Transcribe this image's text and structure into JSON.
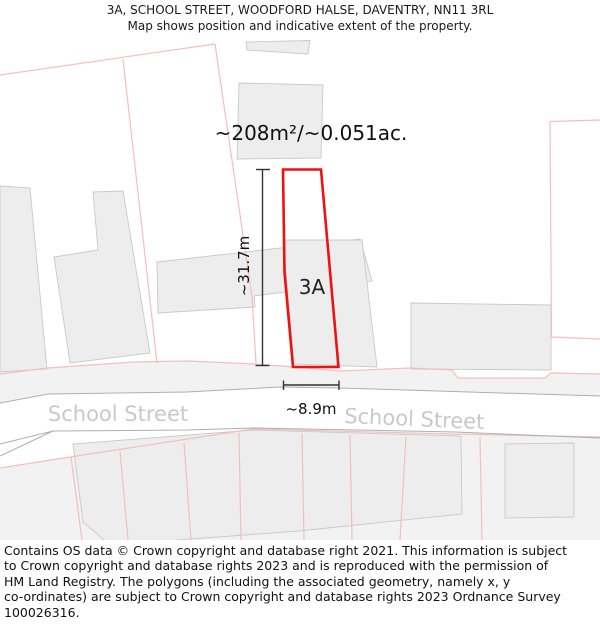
{
  "header": {
    "title": "3A, SCHOOL STREET, WOODFORD HALSE, DAVENTRY, NN11 3RL",
    "subtitle": "Map shows position and indicative extent of the property."
  },
  "map": {
    "colors": {
      "property_red": "#ee1111",
      "parcel_line": "#f4bfbb",
      "building_fill": "#ededed",
      "building_stroke": "#c9c9c9",
      "region_fill": "#f2f2f2",
      "street_edge": "#aeaeae",
      "measure": "#333333",
      "street_label": "#c9c9c9"
    },
    "labels": [
      {
        "name": "area-label",
        "text": "~208m²/~0.051ac.",
        "x": 311,
        "y": 140,
        "size": 20,
        "color": "#111111"
      },
      {
        "name": "plot-label",
        "text": "3A",
        "x": 312,
        "y": 294,
        "size": 20,
        "color": "#222222"
      },
      {
        "name": "height-measure-label",
        "text": "~31.7m",
        "x": 249,
        "y": 266,
        "size": 15,
        "color": "#111111",
        "rotate": -90
      },
      {
        "name": "width-measure-label",
        "text": "~8.9m",
        "x": 311,
        "y": 414,
        "size": 15,
        "color": "#111111"
      },
      {
        "name": "street-label-left",
        "text": "School Street",
        "x": 118,
        "y": 421,
        "size": 21,
        "color": "#c9c9c9"
      },
      {
        "name": "street-label-right",
        "text": "School Street",
        "x": 414,
        "y": 426,
        "size": 21,
        "color": "#c9c9c9",
        "rotate": 2.5
      }
    ],
    "geometry": {
      "regions": [
        {
          "name": "verge-above-street",
          "points": [
            [
              0,
              374
            ],
            [
              48,
              368
            ],
            [
              133,
              362
            ],
            [
              187,
              361
            ],
            [
              255,
              364
            ],
            [
              295,
              367
            ],
            [
              340,
              371
            ],
            [
              410,
              368
            ],
            [
              452,
              370
            ],
            [
              458,
              378
            ],
            [
              545,
              378
            ],
            [
              551,
              373
            ],
            [
              600,
              374
            ],
            [
              600,
              396
            ],
            [
              340,
              388
            ],
            [
              280,
              387
            ],
            [
              187,
              392
            ],
            [
              48,
              394
            ],
            [
              0,
              403
            ]
          ]
        },
        {
          "name": "parcels-below-street",
          "points": [
            [
              0,
              468
            ],
            [
              70,
              457
            ],
            [
              253,
              429
            ],
            [
              455,
              434
            ],
            [
              600,
              437
            ],
            [
              600,
              540
            ],
            [
              0,
              540
            ]
          ]
        }
      ],
      "buildings": [
        [
          [
            246,
            42
          ],
          [
            310,
            40.5
          ],
          [
            308,
            54
          ],
          [
            247,
            50
          ]
        ],
        [
          [
            239,
            83
          ],
          [
            323,
            85
          ],
          [
            321,
            158
          ],
          [
            237,
            159
          ]
        ],
        [
          [
            0,
            186
          ],
          [
            30,
            188
          ],
          [
            47,
            369
          ],
          [
            0,
            372
          ]
        ],
        [
          [
            93,
            192
          ],
          [
            123,
            191
          ],
          [
            150,
            353
          ],
          [
            70,
            363
          ],
          [
            54,
            257
          ],
          [
            98,
            250
          ]
        ],
        [
          [
            157,
            262
          ],
          [
            360,
            239
          ],
          [
            372,
            281
          ],
          [
            254,
            296
          ],
          [
            255,
            307
          ],
          [
            158,
            313
          ]
        ],
        [
          [
            283,
            240
          ],
          [
            362,
            240
          ],
          [
            377,
            367
          ],
          [
            294,
            364
          ]
        ],
        [
          [
            411,
            303
          ],
          [
            551,
            305
          ],
          [
            551,
            370
          ],
          [
            411,
            369
          ]
        ],
        [
          [
            73,
            444
          ],
          [
            253,
            430
          ],
          [
            461,
            436
          ],
          [
            462,
            514
          ],
          [
            299,
            531
          ],
          [
            110,
            545
          ],
          [
            83,
            522
          ]
        ],
        [
          [
            505,
            444
          ],
          [
            574,
            443
          ],
          [
            574,
            517
          ],
          [
            505,
            518
          ]
        ]
      ],
      "parcel_lines": [
        [
          [
            0,
            75
          ],
          [
            215,
            44
          ]
        ],
        [
          [
            123,
            59
          ],
          [
            157,
            363
          ]
        ],
        [
          [
            215,
            44
          ],
          [
            233,
            167
          ],
          [
            252,
            297
          ],
          [
            256,
            363
          ]
        ],
        [
          [
            0,
            374
          ],
          [
            48,
            368
          ],
          [
            133,
            362
          ],
          [
            187,
            361
          ],
          [
            255,
            364
          ],
          [
            295,
            367
          ],
          [
            340,
            371
          ],
          [
            410,
            368
          ],
          [
            452,
            370
          ],
          [
            458,
            378
          ],
          [
            545,
            378
          ],
          [
            551,
            373
          ],
          [
            600,
            374
          ]
        ],
        [
          [
            550,
            121.5
          ],
          [
            600,
            120
          ]
        ],
        [
          [
            550,
            122
          ],
          [
            551.5,
            337
          ],
          [
            600,
            339
          ]
        ],
        [
          [
            0,
            468
          ],
          [
            70,
            457
          ],
          [
            253,
            429
          ],
          [
            455,
            434
          ],
          [
            600,
            437
          ]
        ],
        [
          [
            71,
            457
          ],
          [
            82,
            540
          ]
        ],
        [
          [
            120,
            451
          ],
          [
            128,
            540
          ]
        ],
        [
          [
            184,
            443
          ],
          [
            191,
            540
          ]
        ],
        [
          [
            239,
            433
          ],
          [
            241,
            540
          ]
        ],
        [
          [
            302,
            433
          ],
          [
            304,
            540
          ]
        ],
        [
          [
            350,
            435
          ],
          [
            352,
            540
          ]
        ],
        [
          [
            406,
            437
          ],
          [
            400,
            540
          ]
        ],
        [
          [
            480,
            437
          ],
          [
            482,
            540
          ]
        ]
      ],
      "street_edges": [
        [
          [
            0,
            403
          ],
          [
            48,
            394
          ],
          [
            187,
            392
          ],
          [
            280,
            387
          ],
          [
            340,
            388
          ],
          [
            600,
            396
          ]
        ],
        [
          [
            0,
            444
          ],
          [
            53,
            431
          ],
          [
            187,
            430
          ],
          [
            253,
            428
          ],
          [
            455,
            432
          ],
          [
            600,
            438
          ]
        ],
        [
          [
            0,
            456
          ],
          [
            53,
            431
          ]
        ]
      ],
      "property_outline": [
        [
          283,
          169.5
        ],
        [
          321,
          169.5
        ],
        [
          338.5,
          367
        ],
        [
          293,
          367
        ],
        [
          284.5,
          272
        ]
      ],
      "measure_lines": [
        [
          262.5,
          169.5,
          262.5,
          365.5
        ],
        [
          256,
          169.5,
          270,
          169.5
        ],
        [
          255.5,
          365.5,
          269.5,
          365.5
        ],
        [
          283.5,
          385,
          339,
          385
        ],
        [
          283.5,
          380.5,
          283.5,
          390
        ],
        [
          339,
          380.5,
          339,
          390
        ]
      ]
    }
  },
  "footer": {
    "lines": [
      "Contains OS data © Crown copyright and database right 2021. This information is subject",
      "to Crown copyright and database rights 2023 and is reproduced with the permission of",
      "HM Land Registry. The polygons (including the associated geometry, namely x, y",
      "co-ordinates) are subject to Crown copyright and database rights 2023 Ordnance Survey",
      "100026316."
    ]
  }
}
